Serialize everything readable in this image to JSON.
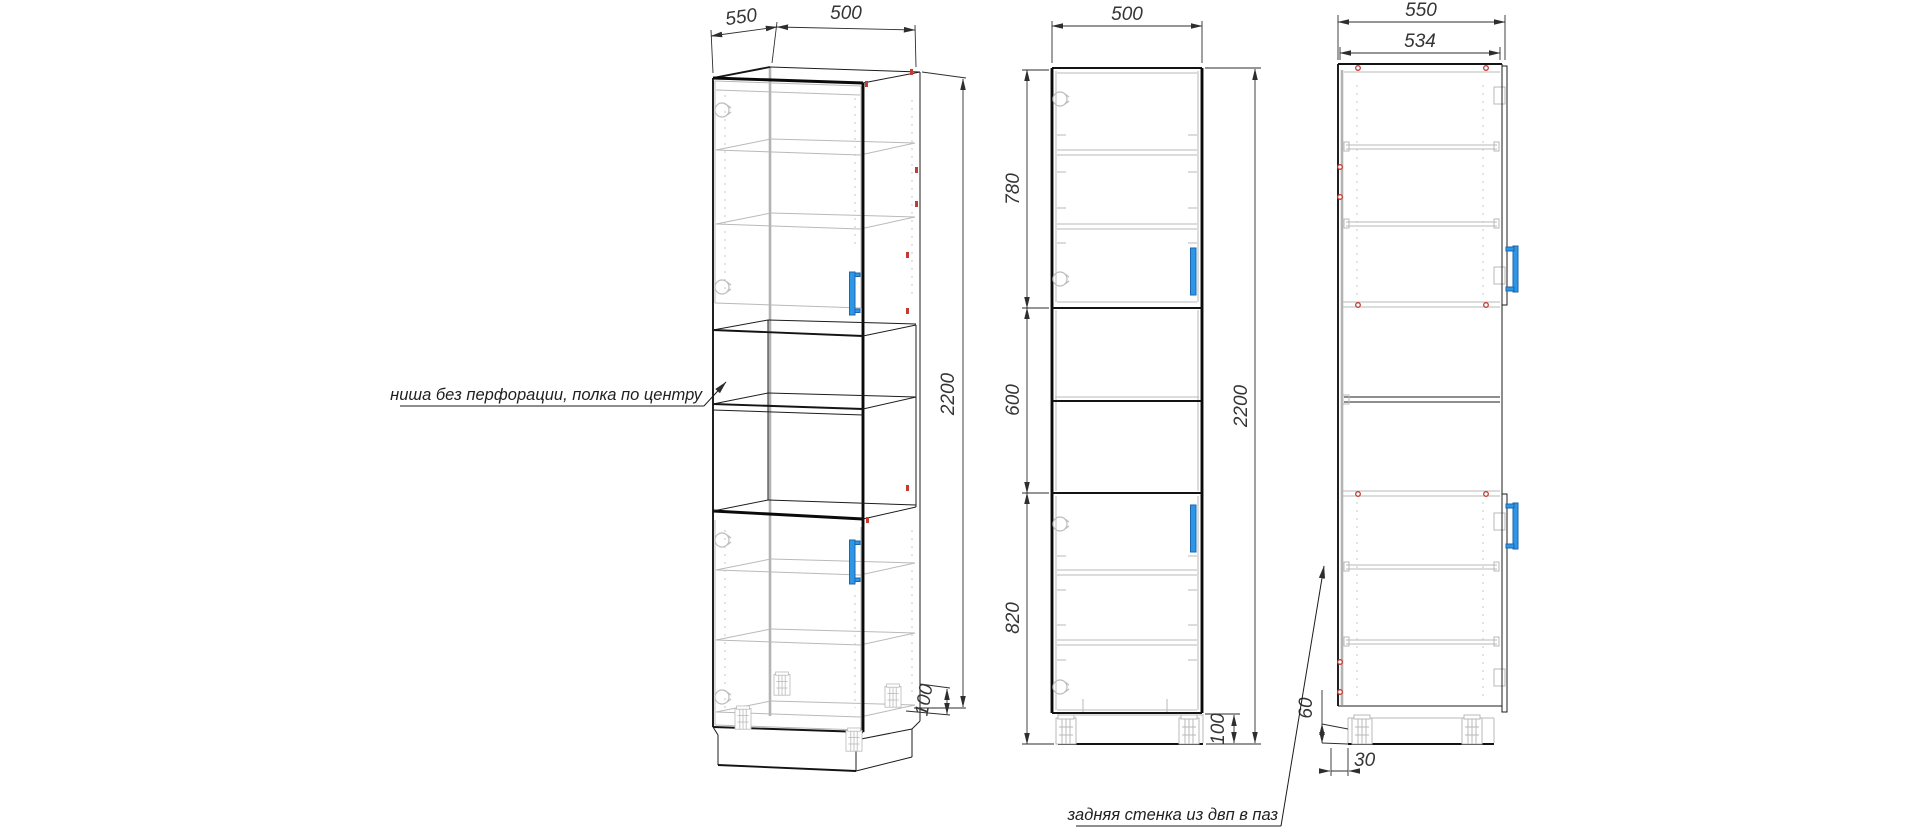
{
  "drawing": {
    "type": "furniture-technical-drawing",
    "colors": {
      "line": "#1c1c1c",
      "hidden_line": "#b9b9b9",
      "handle_accent": "#2e96e6",
      "marker_red": "#c23b35",
      "background": "#ffffff"
    },
    "annotations": {
      "niche_note": "ниша без перфорации, полка по центру",
      "back_panel_note": "задняя стенка из двп в паз"
    },
    "views": {
      "isometric": {
        "dims": {
          "depth": "550",
          "width": "500",
          "height": "2200",
          "plinth": "100"
        }
      },
      "front": {
        "dims": {
          "width": "500",
          "top_section": "780",
          "niche": "600",
          "bottom_section": "820",
          "height": "2200",
          "plinth": "100"
        }
      },
      "side": {
        "dims": {
          "depth": "550",
          "inner_depth": "534",
          "plinth_height": "60",
          "back_offset": "30"
        }
      }
    }
  }
}
